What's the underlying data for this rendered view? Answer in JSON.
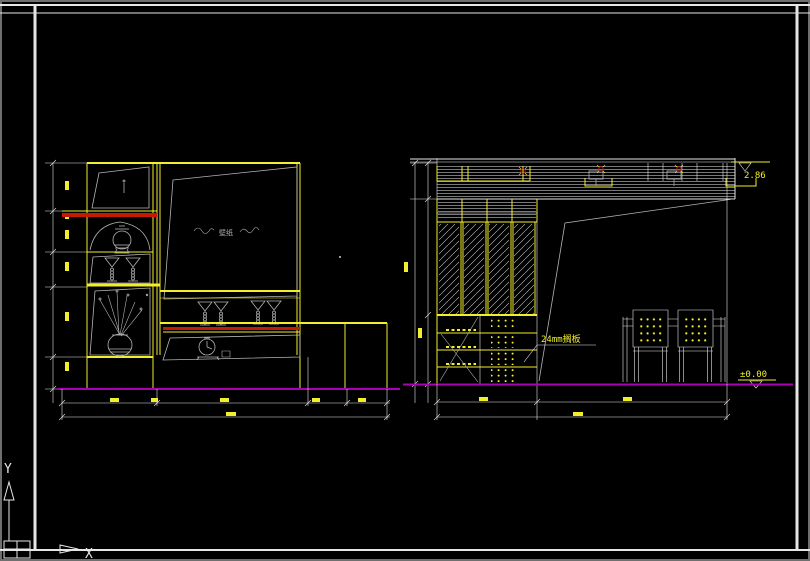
{
  "window": {
    "type": "cad-viewport",
    "background": "#000000",
    "frame_color": "#6f6f6f"
  },
  "colors": {
    "line": "#e6e6e6",
    "gray": "#b4b4b4",
    "yellow": "#f2ee2a",
    "red": "#c41a00",
    "magenta": "#ab00b4",
    "fixture": "#9aa0a8"
  },
  "ucs": {
    "x_label": "X",
    "y_label": "Y"
  },
  "left_elevation": {
    "title": "display-cabinet-elevation",
    "wall_label": "壁纸"
  },
  "right_elevation": {
    "title": "wardrobe-elevation",
    "note": "24mm搁板",
    "elev_top": "2.86",
    "elev_floor": "±0.00"
  }
}
